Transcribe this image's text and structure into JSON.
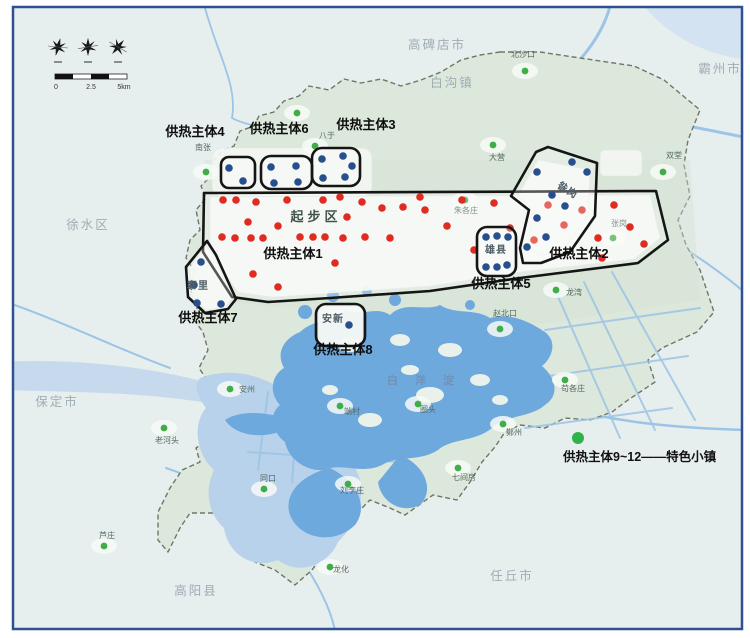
{
  "colors": {
    "red_dot": "#e02b20",
    "blue_dot": "#274e8d",
    "green_dot": "#3fae49",
    "legend_green": "#2eb34a",
    "entity_outline": "#151515",
    "boundary": "#6a6f60",
    "lake": "#6ea9de",
    "marsh": "#b9d2ec",
    "river": "#9cc4e6",
    "land": "#dce8db",
    "outside": "#e7eeee",
    "urban": "#f4f7f3",
    "frame": "#2f5191",
    "city_label": "#9fadb5",
    "town_label": "#55695f",
    "area_label": "#43534b",
    "lake_label": "#7291b4"
  },
  "compass": {
    "scale_ticks": [
      "0",
      "2.5",
      "5km"
    ]
  },
  "legend": {
    "label": "供热主体9~12——特色小镇",
    "dot_pos": [
      578,
      438
    ]
  },
  "map": {
    "city_labels": [
      {
        "text": "高碑店市",
        "pos": [
          437,
          49
        ]
      },
      {
        "text": "白沟镇",
        "pos": [
          452,
          87
        ]
      },
      {
        "text": "霸州市",
        "pos": [
          720,
          73
        ]
      },
      {
        "text": "徐水区",
        "pos": [
          88,
          229
        ]
      },
      {
        "text": "保定市",
        "pos": [
          57,
          406
        ]
      },
      {
        "text": "高阳县",
        "pos": [
          196,
          595
        ]
      },
      {
        "text": "任丘市",
        "pos": [
          512,
          580
        ]
      }
    ],
    "area_labels": [
      {
        "text": "起步区",
        "pos": [
          316,
          221
        ],
        "cls": "area-district"
      },
      {
        "text": "白 洋 淀",
        "pos": [
          424,
          384
        ],
        "cls": "area-lake"
      }
    ],
    "towns": [
      {
        "name": "北沙口",
        "dot": [
          525,
          71
        ],
        "label": [
          523,
          57
        ]
      },
      {
        "name": "",
        "dot": [
          297,
          113
        ],
        "label": [
          297,
          104
        ]
      },
      {
        "name": "八于",
        "dot": [
          315,
          146
        ],
        "label": [
          327,
          138
        ]
      },
      {
        "name": "南张",
        "dot": [
          206,
          172
        ],
        "label": [
          203,
          150
        ]
      },
      {
        "name": "大营",
        "dot": [
          493,
          145
        ],
        "label": [
          497,
          160
        ]
      },
      {
        "name": "双堂",
        "dot": [
          663,
          172
        ],
        "label": [
          674,
          158
        ]
      },
      {
        "name": "张岗",
        "dot": [
          613,
          238
        ],
        "label": [
          619,
          226
        ]
      },
      {
        "name": "朱各庄",
        "dot": [
          465,
          200
        ],
        "label": [
          466,
          213
        ]
      },
      {
        "name": "龙湾",
        "dot": [
          556,
          290
        ],
        "label": [
          574,
          295
        ]
      },
      {
        "name": "赵北口",
        "dot": [
          500,
          329
        ],
        "label": [
          505,
          316
        ]
      },
      {
        "name": "苟各庄",
        "dot": [
          565,
          380
        ],
        "label": [
          573,
          391
        ]
      },
      {
        "name": "鄚州",
        "dot": [
          503,
          424
        ],
        "label": [
          514,
          435
        ]
      },
      {
        "name": "七间房",
        "dot": [
          458,
          468
        ],
        "label": [
          464,
          480
        ]
      },
      {
        "name": "端村",
        "dot": [
          340,
          406
        ],
        "label": [
          352,
          414
        ]
      },
      {
        "name": "圈头",
        "dot": [
          418,
          404
        ],
        "label": [
          428,
          412
        ]
      },
      {
        "name": "刘李庄",
        "dot": [
          348,
          484
        ],
        "label": [
          352,
          493
        ]
      },
      {
        "name": "同口",
        "dot": [
          264,
          489
        ],
        "label": [
          268,
          481
        ]
      },
      {
        "name": "老河头",
        "dot": [
          164,
          428
        ],
        "label": [
          167,
          443
        ]
      },
      {
        "name": "安州",
        "dot": [
          230,
          389
        ],
        "label": [
          247,
          392
        ]
      },
      {
        "name": "芦庄",
        "dot": [
          104,
          546
        ],
        "label": [
          107,
          538
        ]
      },
      {
        "name": "龙化",
        "dot": [
          330,
          567
        ],
        "label": [
          341,
          572
        ]
      }
    ],
    "entities": [
      {
        "id": "1",
        "label": "供热主体1",
        "label_pos": [
          293,
          258
        ],
        "dot_color": "red",
        "shape": {
          "type": "polygon",
          "points": [
            [
              204,
              193
            ],
            [
              656,
              191
            ],
            [
              668,
              240
            ],
            [
              638,
              263
            ],
            [
              520,
              278
            ],
            [
              430,
              291
            ],
            [
              330,
              298
            ],
            [
              268,
              302
            ],
            [
              232,
              297
            ],
            [
              203,
              252
            ]
          ]
        },
        "dots": [
          [
            223,
            200
          ],
          [
            236,
            200
          ],
          [
            256,
            202
          ],
          [
            287,
            200
          ],
          [
            248,
            222
          ],
          [
            278,
            226
          ],
          [
            222,
            237
          ],
          [
            235,
            238
          ],
          [
            251,
            238
          ],
          [
            263,
            238
          ],
          [
            300,
            237
          ],
          [
            313,
            237
          ],
          [
            323,
            200
          ],
          [
            340,
            197
          ],
          [
            347,
            217
          ],
          [
            325,
            237
          ],
          [
            343,
            238
          ],
          [
            365,
            237
          ],
          [
            390,
            238
          ],
          [
            335,
            263
          ],
          [
            253,
            274
          ],
          [
            278,
            287
          ],
          [
            362,
            202
          ],
          [
            382,
            208
          ],
          [
            403,
            207
          ],
          [
            420,
            197
          ],
          [
            425,
            210
          ],
          [
            447,
            226
          ],
          [
            462,
            200
          ],
          [
            474,
            250
          ],
          [
            494,
            203
          ],
          [
            510,
            228
          ],
          [
            534,
            240
          ],
          [
            548,
            205
          ],
          [
            564,
            225
          ],
          [
            582,
            210
          ],
          [
            598,
            238
          ],
          [
            614,
            205
          ],
          [
            630,
            227
          ],
          [
            644,
            244
          ],
          [
            602,
            258
          ]
        ]
      },
      {
        "id": "2",
        "label": "供热主体2",
        "label_pos": [
          579,
          258
        ],
        "dot_color": "blue",
        "shape": {
          "type": "polygon",
          "points": [
            [
              548,
              147
            ],
            [
              597,
              163
            ],
            [
              595,
              216
            ],
            [
              570,
              252
            ],
            [
              541,
              263
            ],
            [
              523,
              263
            ],
            [
              520,
              248
            ],
            [
              529,
              210
            ],
            [
              511,
              196
            ],
            [
              536,
              152
            ]
          ]
        },
        "inner_label": {
          "text": "昝岗",
          "pos": [
            566,
            193
          ],
          "rotate": 32
        },
        "dots": [
          [
            572,
            162
          ],
          [
            537,
            172
          ],
          [
            587,
            172
          ],
          [
            552,
            195
          ],
          [
            565,
            206
          ],
          [
            537,
            218
          ],
          [
            546,
            237
          ],
          [
            527,
            247
          ]
        ]
      },
      {
        "id": "3",
        "label": "供热主体3",
        "label_pos": [
          366,
          129
        ],
        "dot_color": "blue",
        "shape": {
          "type": "rect",
          "x": 312,
          "y": 148,
          "w": 48,
          "h": 38,
          "r": 10
        },
        "dots": [
          [
            322,
            159
          ],
          [
            343,
            156
          ],
          [
            352,
            166
          ],
          [
            323,
            178
          ],
          [
            345,
            177
          ]
        ]
      },
      {
        "id": "4",
        "label": "供热主体4",
        "label_pos": [
          195,
          136
        ],
        "dot_color": "blue",
        "shape": {
          "type": "rect",
          "x": 221,
          "y": 157,
          "w": 34,
          "h": 31,
          "r": 8
        },
        "dots": [
          [
            229,
            168
          ],
          [
            243,
            181
          ]
        ]
      },
      {
        "id": "5",
        "label": "供热主体5",
        "label_pos": [
          501,
          288
        ],
        "dot_color": "blue",
        "shape": {
          "type": "rect",
          "x": 477,
          "y": 227,
          "w": 39,
          "h": 49,
          "r": 10
        },
        "inner_label": {
          "text": "雄县",
          "pos": [
            496,
            253
          ],
          "rotate": 0
        },
        "dots": [
          [
            486,
            237
          ],
          [
            497,
            236
          ],
          [
            508,
            237
          ],
          [
            486,
            267
          ],
          [
            497,
            267
          ],
          [
            507,
            265
          ]
        ]
      },
      {
        "id": "6",
        "label": "供热主体6",
        "label_pos": [
          279,
          133
        ],
        "dot_color": "blue",
        "shape": {
          "type": "rect",
          "x": 261,
          "y": 156,
          "w": 51,
          "h": 33,
          "r": 10
        },
        "dots": [
          [
            271,
            167
          ],
          [
            296,
            166
          ],
          [
            274,
            183
          ],
          [
            298,
            182
          ]
        ]
      },
      {
        "id": "7",
        "label": "供热主体7",
        "label_pos": [
          208,
          322
        ],
        "dot_color": "blue",
        "shape": {
          "type": "polygon",
          "points": [
            [
              207,
              241
            ],
            [
              186,
              267
            ],
            [
              188,
              297
            ],
            [
              205,
              313
            ],
            [
              228,
              309
            ],
            [
              236,
              299
            ],
            [
              216,
              255
            ]
          ]
        },
        "inner_label": {
          "text": "寨里",
          "pos": [
            198,
            289
          ],
          "rotate": 0
        },
        "dots": [
          [
            201,
            262
          ],
          [
            194,
            285
          ],
          [
            197,
            303
          ],
          [
            221,
            304
          ]
        ]
      },
      {
        "id": "8",
        "label": "供热主体8",
        "label_pos": [
          343,
          354
        ],
        "dot_color": "blue",
        "shape": {
          "type": "rect",
          "x": 316,
          "y": 304,
          "w": 49,
          "h": 42,
          "r": 10
        },
        "inner_label": {
          "text": "安新",
          "pos": [
            333,
            322
          ],
          "rotate": 0
        },
        "dots": [
          [
            349,
            325
          ]
        ]
      }
    ]
  }
}
